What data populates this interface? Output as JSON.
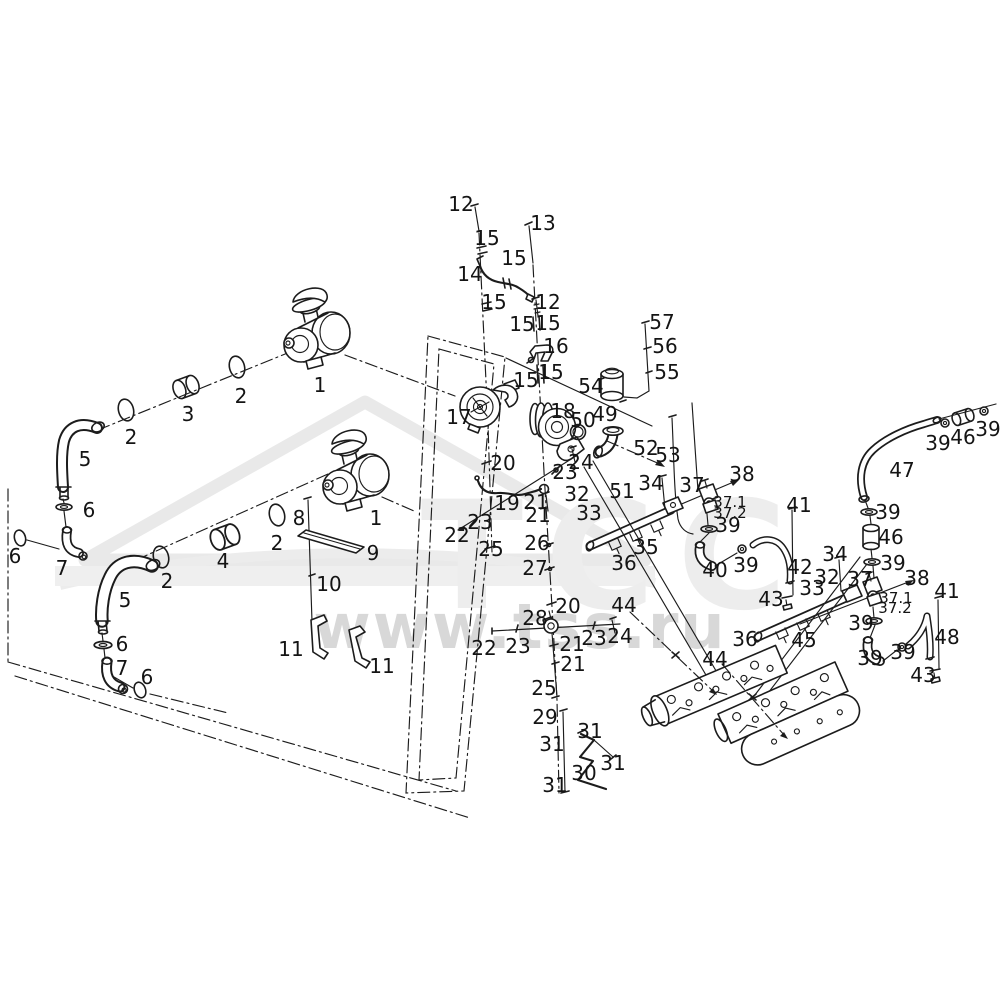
{
  "watermark": {
    "logo": "tss-triangle-logo",
    "logo_letters": "ТСС",
    "url_text": "www.tss.ru"
  },
  "diagram": {
    "type": "exploded-parts-diagram",
    "callouts": [
      {
        "t": "1",
        "x": 320,
        "y": 385
      },
      {
        "t": "2",
        "x": 241,
        "y": 396
      },
      {
        "t": "3",
        "x": 188,
        "y": 414
      },
      {
        "t": "2",
        "x": 131,
        "y": 437
      },
      {
        "t": "5",
        "x": 85,
        "y": 459
      },
      {
        "t": "6",
        "x": 89,
        "y": 510
      },
      {
        "t": "6",
        "x": 15,
        "y": 556
      },
      {
        "t": "7",
        "x": 62,
        "y": 568
      },
      {
        "t": "8",
        "x": 299,
        "y": 518
      },
      {
        "t": "2",
        "x": 277,
        "y": 543
      },
      {
        "t": "4",
        "x": 223,
        "y": 561
      },
      {
        "t": "2",
        "x": 167,
        "y": 581
      },
      {
        "t": "1",
        "x": 376,
        "y": 518
      },
      {
        "t": "9",
        "x": 373,
        "y": 553
      },
      {
        "t": "10",
        "x": 329,
        "y": 584
      },
      {
        "t": "5",
        "x": 125,
        "y": 600
      },
      {
        "t": "6",
        "x": 122,
        "y": 644
      },
      {
        "t": "7",
        "x": 122,
        "y": 668
      },
      {
        "t": "6",
        "x": 147,
        "y": 677
      },
      {
        "t": "11",
        "x": 291,
        "y": 649
      },
      {
        "t": "11",
        "x": 382,
        "y": 666
      },
      {
        "t": "12",
        "x": 461,
        "y": 204
      },
      {
        "t": "15",
        "x": 487,
        "y": 238
      },
      {
        "t": "13",
        "x": 543,
        "y": 223
      },
      {
        "t": "15",
        "x": 514,
        "y": 258
      },
      {
        "t": "14",
        "x": 470,
        "y": 274
      },
      {
        "t": "15",
        "x": 494,
        "y": 302
      },
      {
        "t": "12",
        "x": 548,
        "y": 302
      },
      {
        "t": "15",
        "x": 522,
        "y": 324
      },
      {
        "t": "15",
        "x": 548,
        "y": 323
      },
      {
        "t": "16",
        "x": 556,
        "y": 346
      },
      {
        "t": "15",
        "x": 526,
        "y": 380
      },
      {
        "t": "15",
        "x": 551,
        "y": 372
      },
      {
        "t": "17",
        "x": 459,
        "y": 417
      },
      {
        "t": "18",
        "x": 563,
        "y": 411
      },
      {
        "t": "50",
        "x": 583,
        "y": 420
      },
      {
        "t": "49",
        "x": 605,
        "y": 414
      },
      {
        "t": "54",
        "x": 591,
        "y": 386
      },
      {
        "t": "57",
        "x": 662,
        "y": 322
      },
      {
        "t": "56",
        "x": 665,
        "y": 346
      },
      {
        "t": "55",
        "x": 667,
        "y": 372
      },
      {
        "t": "52",
        "x": 646,
        "y": 448
      },
      {
        "t": "53",
        "x": 668,
        "y": 455
      },
      {
        "t": "51",
        "x": 622,
        "y": 491
      },
      {
        "t": "20",
        "x": 503,
        "y": 463
      },
      {
        "t": "24",
        "x": 581,
        "y": 462
      },
      {
        "t": "23",
        "x": 565,
        "y": 472
      },
      {
        "t": "19",
        "x": 507,
        "y": 503
      },
      {
        "t": "21",
        "x": 536,
        "y": 502
      },
      {
        "t": "21",
        "x": 538,
        "y": 515
      },
      {
        "t": "23",
        "x": 480,
        "y": 522
      },
      {
        "t": "22",
        "x": 457,
        "y": 535
      },
      {
        "t": "25",
        "x": 491,
        "y": 549
      },
      {
        "t": "26",
        "x": 537,
        "y": 543
      },
      {
        "t": "27",
        "x": 535,
        "y": 568
      },
      {
        "t": "32",
        "x": 577,
        "y": 494
      },
      {
        "t": "33",
        "x": 589,
        "y": 513
      },
      {
        "t": "34",
        "x": 651,
        "y": 483
      },
      {
        "t": "37",
        "x": 692,
        "y": 485
      },
      {
        "t": "38",
        "x": 742,
        "y": 474
      },
      {
        "t": "37.1",
        "x": 730,
        "y": 502
      },
      {
        "t": "37.2",
        "x": 730,
        "y": 513
      },
      {
        "t": "39",
        "x": 728,
        "y": 525
      },
      {
        "t": "35",
        "x": 646,
        "y": 547
      },
      {
        "t": "36",
        "x": 624,
        "y": 563
      },
      {
        "t": "40",
        "x": 715,
        "y": 570
      },
      {
        "t": "39",
        "x": 746,
        "y": 565
      },
      {
        "t": "41",
        "x": 799,
        "y": 505
      },
      {
        "t": "42",
        "x": 800,
        "y": 567
      },
      {
        "t": "43",
        "x": 771,
        "y": 599
      },
      {
        "t": "39",
        "x": 938,
        "y": 443
      },
      {
        "t": "46",
        "x": 963,
        "y": 437
      },
      {
        "t": "39",
        "x": 988,
        "y": 429
      },
      {
        "t": "47",
        "x": 902,
        "y": 470
      },
      {
        "t": "39",
        "x": 888,
        "y": 512
      },
      {
        "t": "46",
        "x": 891,
        "y": 537
      },
      {
        "t": "39",
        "x": 893,
        "y": 563
      },
      {
        "t": "34",
        "x": 835,
        "y": 554
      },
      {
        "t": "32",
        "x": 827,
        "y": 577
      },
      {
        "t": "33",
        "x": 812,
        "y": 588
      },
      {
        "t": "37",
        "x": 860,
        "y": 579
      },
      {
        "t": "38",
        "x": 917,
        "y": 578
      },
      {
        "t": "37.1",
        "x": 896,
        "y": 598
      },
      {
        "t": "37.2",
        "x": 895,
        "y": 608
      },
      {
        "t": "39",
        "x": 861,
        "y": 623
      },
      {
        "t": "41",
        "x": 947,
        "y": 591
      },
      {
        "t": "48",
        "x": 947,
        "y": 637
      },
      {
        "t": "39",
        "x": 870,
        "y": 658
      },
      {
        "t": "39",
        "x": 903,
        "y": 652
      },
      {
        "t": "43",
        "x": 923,
        "y": 675
      },
      {
        "t": "20",
        "x": 568,
        "y": 606
      },
      {
        "t": "28",
        "x": 535,
        "y": 618
      },
      {
        "t": "22",
        "x": 484,
        "y": 648
      },
      {
        "t": "23",
        "x": 518,
        "y": 646
      },
      {
        "t": "21",
        "x": 572,
        "y": 644
      },
      {
        "t": "23",
        "x": 594,
        "y": 638
      },
      {
        "t": "24",
        "x": 620,
        "y": 636
      },
      {
        "t": "21",
        "x": 573,
        "y": 664
      },
      {
        "t": "25",
        "x": 544,
        "y": 688
      },
      {
        "t": "29",
        "x": 545,
        "y": 717
      },
      {
        "t": "31",
        "x": 552,
        "y": 744
      },
      {
        "t": "31",
        "x": 590,
        "y": 731
      },
      {
        "t": "31",
        "x": 613,
        "y": 763
      },
      {
        "t": "30",
        "x": 584,
        "y": 773
      },
      {
        "t": "31",
        "x": 555,
        "y": 785
      },
      {
        "t": "44",
        "x": 624,
        "y": 605
      },
      {
        "t": "44",
        "x": 715,
        "y": 659
      },
      {
        "t": "36",
        "x": 745,
        "y": 639
      },
      {
        "t": "45",
        "x": 804,
        "y": 640
      }
    ]
  }
}
